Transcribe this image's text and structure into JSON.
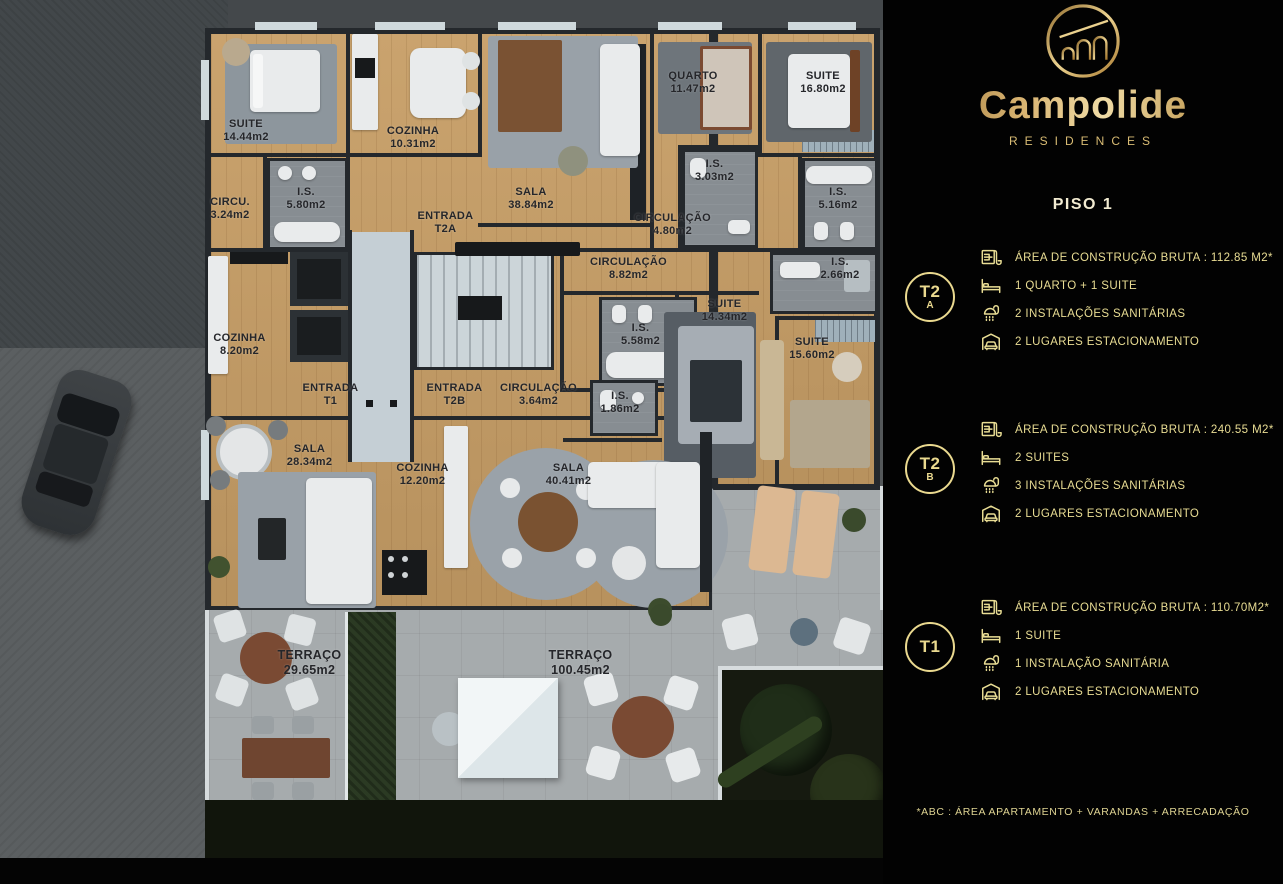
{
  "brand": {
    "name": "Campolide",
    "subtitle": "RESIDENCES"
  },
  "page_title": "PISO 1",
  "accent_color": "#EAD98F",
  "panel_bg": "#020202",
  "units": [
    {
      "id": "T2A",
      "badge_main": "T2",
      "badge_sub": "A",
      "specs": [
        {
          "icon": "floorplan-icon",
          "text": "ÁREA DE CONSTRUÇÃO BRUTA :  112.85 M2*"
        },
        {
          "icon": "bed-icon",
          "text": "1 QUARTO + 1 SUITE"
        },
        {
          "icon": "shower-icon",
          "text": "2 INSTALAÇÕES SANITÁRIAS"
        },
        {
          "icon": "car-icon",
          "text": "2 LUGARES ESTACIONAMENTO"
        }
      ]
    },
    {
      "id": "T2B",
      "badge_main": "T2",
      "badge_sub": "B",
      "specs": [
        {
          "icon": "floorplan-icon",
          "text": "ÁREA DE CONSTRUÇÃO BRUTA :  240.55 M2*"
        },
        {
          "icon": "bed-icon",
          "text": "2 SUITES"
        },
        {
          "icon": "shower-icon",
          "text": "3 INSTALAÇÕES SANITÁRIAS"
        },
        {
          "icon": "car-icon",
          "text": "2 LUGARES ESTACIONAMENTO"
        }
      ]
    },
    {
      "id": "T1",
      "badge_main": "T1",
      "badge_sub": "",
      "specs": [
        {
          "icon": "floorplan-icon",
          "text": "ÁREA DE CONSTRUÇÃO BRUTA :  110.70M2*"
        },
        {
          "icon": "bed-icon",
          "text": "1 SUITE"
        },
        {
          "icon": "shower-icon",
          "text": "1 INSTALAÇÃO SANITÁRIA"
        },
        {
          "icon": "car-icon",
          "text": "2 LUGARES ESTACIONAMENTO"
        }
      ]
    }
  ],
  "footnote": "*ABC :  ÁREA APARTAMENTO + VARANDAS + ARRECADAÇÃO",
  "floorplan": {
    "rooms": [
      {
        "name": "SUITE",
        "area": "14.44m2"
      },
      {
        "name": "COZINHA",
        "area": "10.31m2"
      },
      {
        "name": "SALA",
        "area": "38.84m2"
      },
      {
        "name": "QUARTO",
        "area": "11.47m2"
      },
      {
        "name": "SUITE",
        "area": "16.80m2"
      },
      {
        "name": "CIRCU.",
        "area": "3.24m2"
      },
      {
        "name": "I.S.",
        "area": "5.80m2"
      },
      {
        "name": "ENTRADA",
        "area": "T2A"
      },
      {
        "name": "CIRCULAÇÃO",
        "area": "4.80m2"
      },
      {
        "name": "I.S.",
        "area": "3.03m2"
      },
      {
        "name": "I.S.",
        "area": "5.16m2"
      },
      {
        "name": "CIRCULAÇÃO",
        "area": "8.82m2"
      },
      {
        "name": "I.S.",
        "area": "2.66m2"
      },
      {
        "name": "SUITE",
        "area": "14.34m2"
      },
      {
        "name": "I.S.",
        "area": "5.58m2"
      },
      {
        "name": "SUITE",
        "area": "15.60m2"
      },
      {
        "name": "COZINHA",
        "area": "8.20m2"
      },
      {
        "name": "ENTRADA",
        "area": "T1"
      },
      {
        "name": "ENTRADA",
        "area": "T2B"
      },
      {
        "name": "CIRCULAÇÃO",
        "area": "3.64m2"
      },
      {
        "name": "I.S.",
        "area": "1.86m2"
      },
      {
        "name": "SALA",
        "area": "28.34m2"
      },
      {
        "name": "COZINHA",
        "area": "12.20m2"
      },
      {
        "name": "SALA",
        "area": "40.41m2"
      },
      {
        "name": "TERRAÇO",
        "area": "29.65m2"
      },
      {
        "name": "TERRAÇO",
        "area": "100.45m2"
      }
    ]
  }
}
